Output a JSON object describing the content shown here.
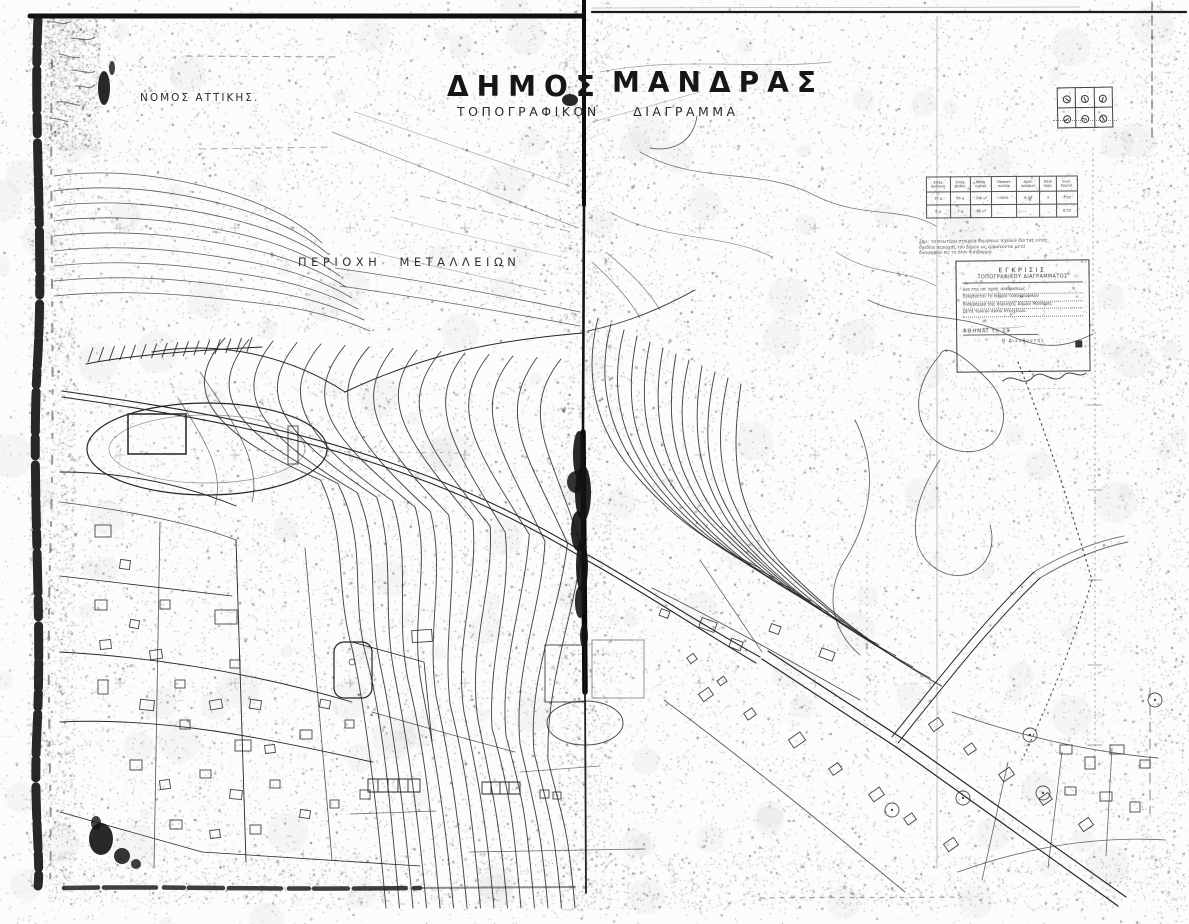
{
  "document": {
    "title_word1": "ΔΗΜΟΣ",
    "title_word2": "ΜΑΝΔΡΑΣ",
    "subtitle": "ΤΟΠΟΓΡΑΦΙΚΟΝ ΔΙΑΓΡΑΜΜΑ",
    "prefecture_label": "ΝΟΜΟΣ ΑΤΤΙΚΗΣ.",
    "mining_area_label": "ΠΕΡΙΟΧΗ ΜΕΤΑΛΛΕΙΩΝ"
  },
  "reg_table": {
    "headers": [
      "Ελάχ. πρόσωπ.",
      "Ελάχ. βάθος",
      "Ελάχ. εμβαδ.",
      "Ποσοστ. καλύψ.",
      "Αριθ. ορόφων",
      "Μέγ. ύψος",
      "Συντ. δομήσ."
    ],
    "rows": [
      [
        "10 μ.",
        "16 μ.",
        "300 μ²",
        "60%",
        "2,00",
        "3",
        "7,50"
      ],
      [
        "8 μ.",
        "7 μ.",
        "80 μ²",
        "",
        "",
        "",
        "8,50"
      ]
    ]
  },
  "notes": [
    "Σημ.: τα ανωτέρω στοιχεία δομήσεως ισχύουν δια τας εντός",
    "σχεδίου περιοχάς του Δήμου ως εμφαίνονται μετά",
    "διαγραφών εις το όλον διάγραμμα."
  ],
  "stamp": {
    "heading1": "ΕΓΚΡΙΣΙΣ",
    "heading2": "ΤΟΠΟΓΡΑΦΙΚΟΥ ΔΙΑΓΡΑΜΜΑΤΟΣ",
    "body": [
      "Δια της υπ' αριθ. αποφάσεως",
      "εγκρίνεται το παρόν τοπογραφικόν",
      "διάγραμμα της περιοχής Δήμου Μάνδρας",
      "μετά των εν αυτώ στοιχείων."
    ],
    "date_line": "ΑΘΗΝΑΙ τη 19",
    "signer_line": "Ο Διευθυντής"
  },
  "colors": {
    "ink": "#1b1b1b",
    "paper": "#fcfcfa"
  }
}
